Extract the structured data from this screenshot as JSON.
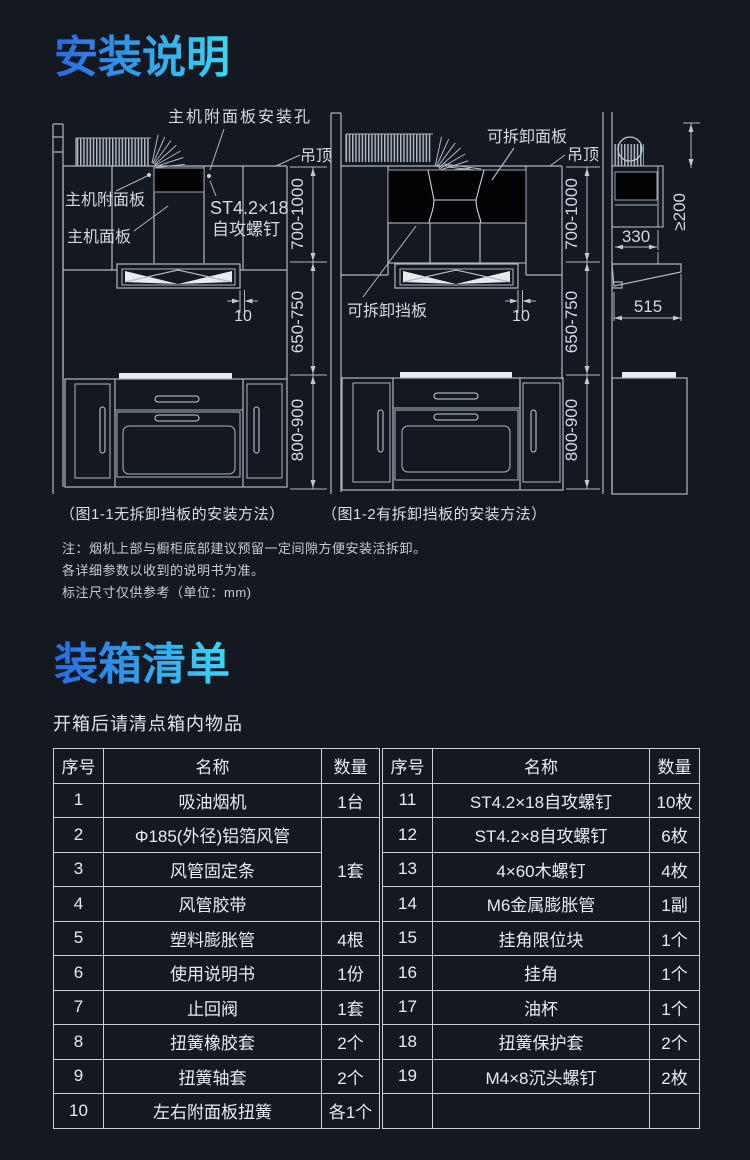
{
  "install": {
    "title": "安装说明"
  },
  "diagram1": {
    "caption": "（图1-1无拆卸挡板的安装方法）",
    "labels": {
      "hole": "主机附面板安装孔",
      "ceiling": "吊顶",
      "attach_panel": "主机附面板",
      "main_panel": "主机面板",
      "screw_line1": "ST4.2×18",
      "screw_line2": "自攻螺钉",
      "dim_top": "700-1000",
      "dim_mid": "650-750",
      "dim_bottom": "800-900",
      "gap": "10"
    }
  },
  "diagram2": {
    "caption": "（图1-2有拆卸挡板的安装方法）",
    "labels": {
      "panel": "可拆卸面板",
      "ceiling": "吊顶",
      "baffle": "可拆卸挡板",
      "dim_top": "700-1000",
      "dim_mid": "650-750",
      "dim_bottom": "800-900",
      "gap": "10"
    }
  },
  "diagram3": {
    "labels": {
      "clearance": "≥200",
      "width": "330",
      "depth": "515"
    }
  },
  "notes": {
    "line1": "注：烟机上部与橱柜底部建议预留一定间隙方便安装活拆卸。",
    "line2": "各详细参数以收到的说明书为准。",
    "line3": "标注尺寸仅供参考（单位：mm)"
  },
  "packing": {
    "title": "装箱清单",
    "subtitle": "开箱后请清点箱内物品",
    "headers": [
      "序号",
      "名称",
      "数量"
    ],
    "left": [
      {
        "no": "1",
        "name": "吸油烟机",
        "qty": "1台"
      },
      {
        "no": "2",
        "name": "Φ185(外径)铝箔风管",
        "qty": "1套"
      },
      {
        "no": "3",
        "name": "风管固定条"
      },
      {
        "no": "4",
        "name": "风管胶带"
      },
      {
        "no": "5",
        "name": "塑料膨胀管",
        "qty": "4根"
      },
      {
        "no": "6",
        "name": "使用说明书",
        "qty": "1份"
      },
      {
        "no": "7",
        "name": "止回阀",
        "qty": "1套"
      },
      {
        "no": "8",
        "name": "扭簧橡胶套",
        "qty": "2个"
      },
      {
        "no": "9",
        "name": "扭簧轴套",
        "qty": "2个"
      },
      {
        "no": "10",
        "name": "左右附面板扭簧",
        "qty": "各1个"
      }
    ],
    "right": [
      {
        "no": "11",
        "name": "ST4.2×18自攻螺钉",
        "qty": "10枚"
      },
      {
        "no": "12",
        "name": "ST4.2×8自攻螺钉",
        "qty": "6枚"
      },
      {
        "no": "13",
        "name": "4×60木螺钉",
        "qty": "4枚"
      },
      {
        "no": "14",
        "name": "M6金属膨胀管",
        "qty": "1副"
      },
      {
        "no": "15",
        "name": "挂角限位块",
        "qty": "1个"
      },
      {
        "no": "16",
        "name": "挂角",
        "qty": "1个"
      },
      {
        "no": "17",
        "name": "油杯",
        "qty": "1个"
      },
      {
        "no": "18",
        "name": "扭簧保护套",
        "qty": "2个"
      },
      {
        "no": "19",
        "name": "M4×8沉头螺钉",
        "qty": "2枚"
      },
      {
        "no": "",
        "name": "",
        "qty": ""
      }
    ]
  }
}
